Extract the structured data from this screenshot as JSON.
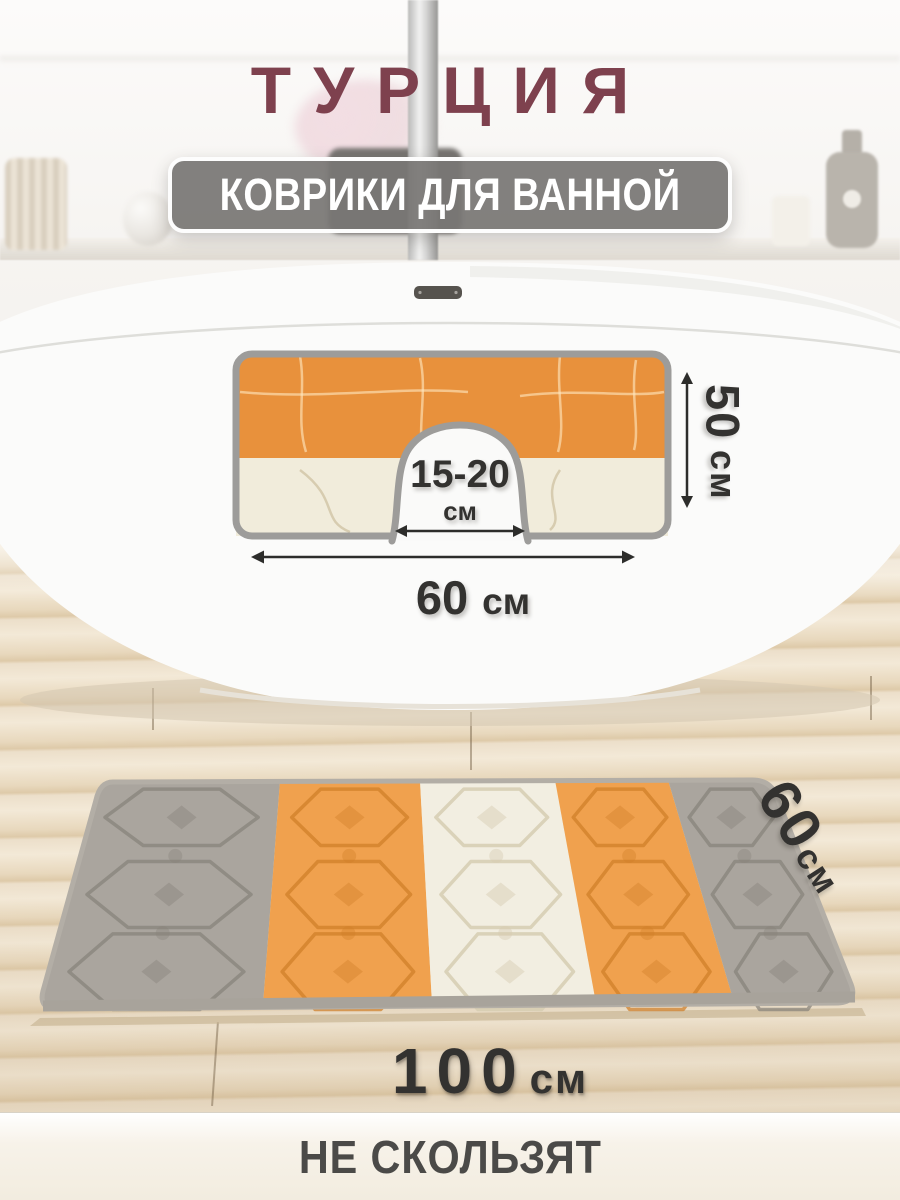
{
  "title": "ТУРЦИЯ",
  "badge": "КОВРИКИ ДЛЯ ВАННОЙ",
  "contour_mat": {
    "height_value": "50",
    "height_unit": "см",
    "cutout_value": "15-20",
    "cutout_unit": "см",
    "width_value": "60",
    "width_unit": "см"
  },
  "rect_mat": {
    "height_value": "60",
    "height_unit": "см",
    "length_value": "100",
    "length_unit": "см"
  },
  "footer_note": "НЕ СКОЛЬЗЯТ",
  "colors": {
    "title_maroon": "#7e414e",
    "badge_gray": "#7b7876",
    "annotation_dark": "#333230",
    "mat_orange": "#e8913c",
    "mat_cream": "#f1ecdb",
    "stripe_gray": "#aaa59e",
    "stripe_orange": "#f0a14e",
    "stripe_cream": "#f2eee1",
    "edge_gray": "#9d9c9a",
    "floor_beige": "#ead9c0"
  }
}
